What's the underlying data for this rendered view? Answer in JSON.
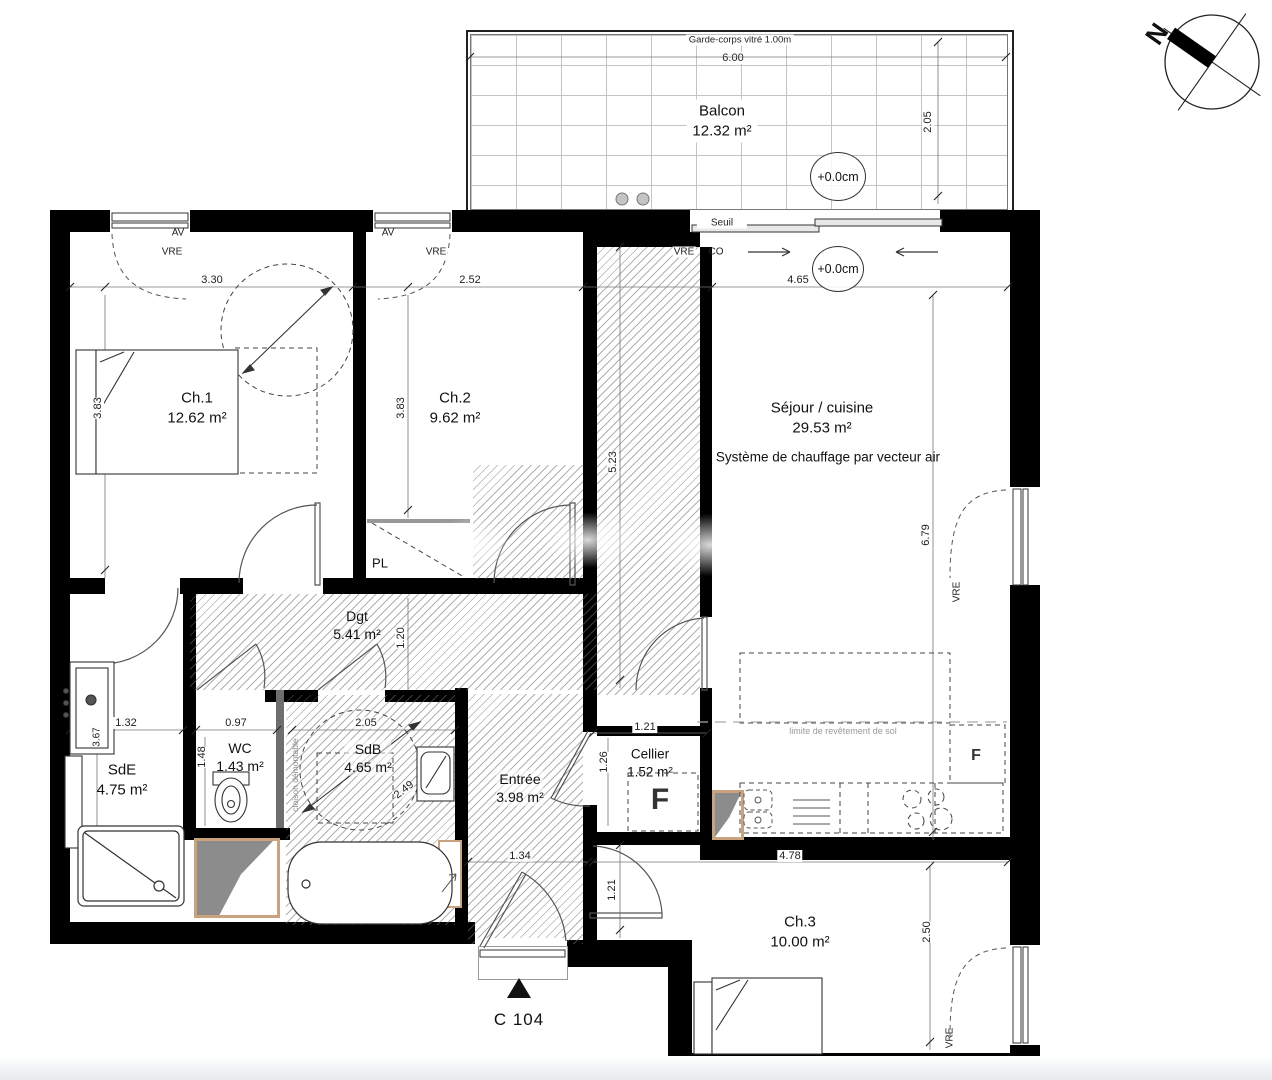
{
  "plan": {
    "unit_label": "C 104",
    "compass": {
      "north": "N"
    },
    "balcony": {
      "name": "Balcon",
      "area": "12.32 m²",
      "railing": "Garde-corps vitré 1.00m",
      "width_dim": "6.00",
      "depth_dim": "2.05",
      "level": "+0.0cm",
      "threshold": "Seuil"
    },
    "rooms": {
      "ch1": {
        "name": "Ch.1",
        "area": "12.62 m²"
      },
      "ch2": {
        "name": "Ch.2",
        "area": "9.62 m²"
      },
      "ch3": {
        "name": "Ch.3",
        "area": "10.00 m²"
      },
      "sejour": {
        "name": "Séjour / cuisine",
        "area": "29.53 m²",
        "note": "Système de chauffage par vecteur air"
      },
      "dgt": {
        "name": "Dgt",
        "area": "5.41 m²"
      },
      "sde": {
        "name": "SdE",
        "area": "4.75 m²"
      },
      "wc": {
        "name": "WC",
        "area": "1.43 m²"
      },
      "sdb": {
        "name": "SdB",
        "area": "4.65 m²"
      },
      "entree": {
        "name": "Entrée",
        "area": "3.98 m²"
      },
      "cellier": {
        "name": "Cellier",
        "area": "1.52 m²"
      },
      "pl": {
        "name": "PL"
      }
    },
    "annotations": {
      "av": "AV",
      "vre": "VRE",
      "co": "CO",
      "level_interior": "+0.0cm",
      "partition": "cloison démontable",
      "floor_limit": "limite de revêtement de sol",
      "fridge": "F",
      "outlet": "F"
    },
    "dimensions": {
      "ch1_width": "3.30",
      "ch1_depth": "3.83",
      "ch2_width": "2.52",
      "ch2_depth": "3.83",
      "shaft_depth": "5.23",
      "sejour_width": "4.65",
      "sejour_depth": "6.79",
      "dgt_width": "1.20",
      "sde_width": "1.32",
      "sde_depth": "3.67",
      "wc_width": "0.97",
      "wc_depth": "1.48",
      "sdb_width": "2.05",
      "sdb_depth": "2.49",
      "entree_width": "1.34",
      "cellier_width": "1.21",
      "cellier_depth": "1.26",
      "hall_depth": "1.21",
      "ch3_width": "4.78",
      "ch3_depth": "2.50"
    }
  }
}
